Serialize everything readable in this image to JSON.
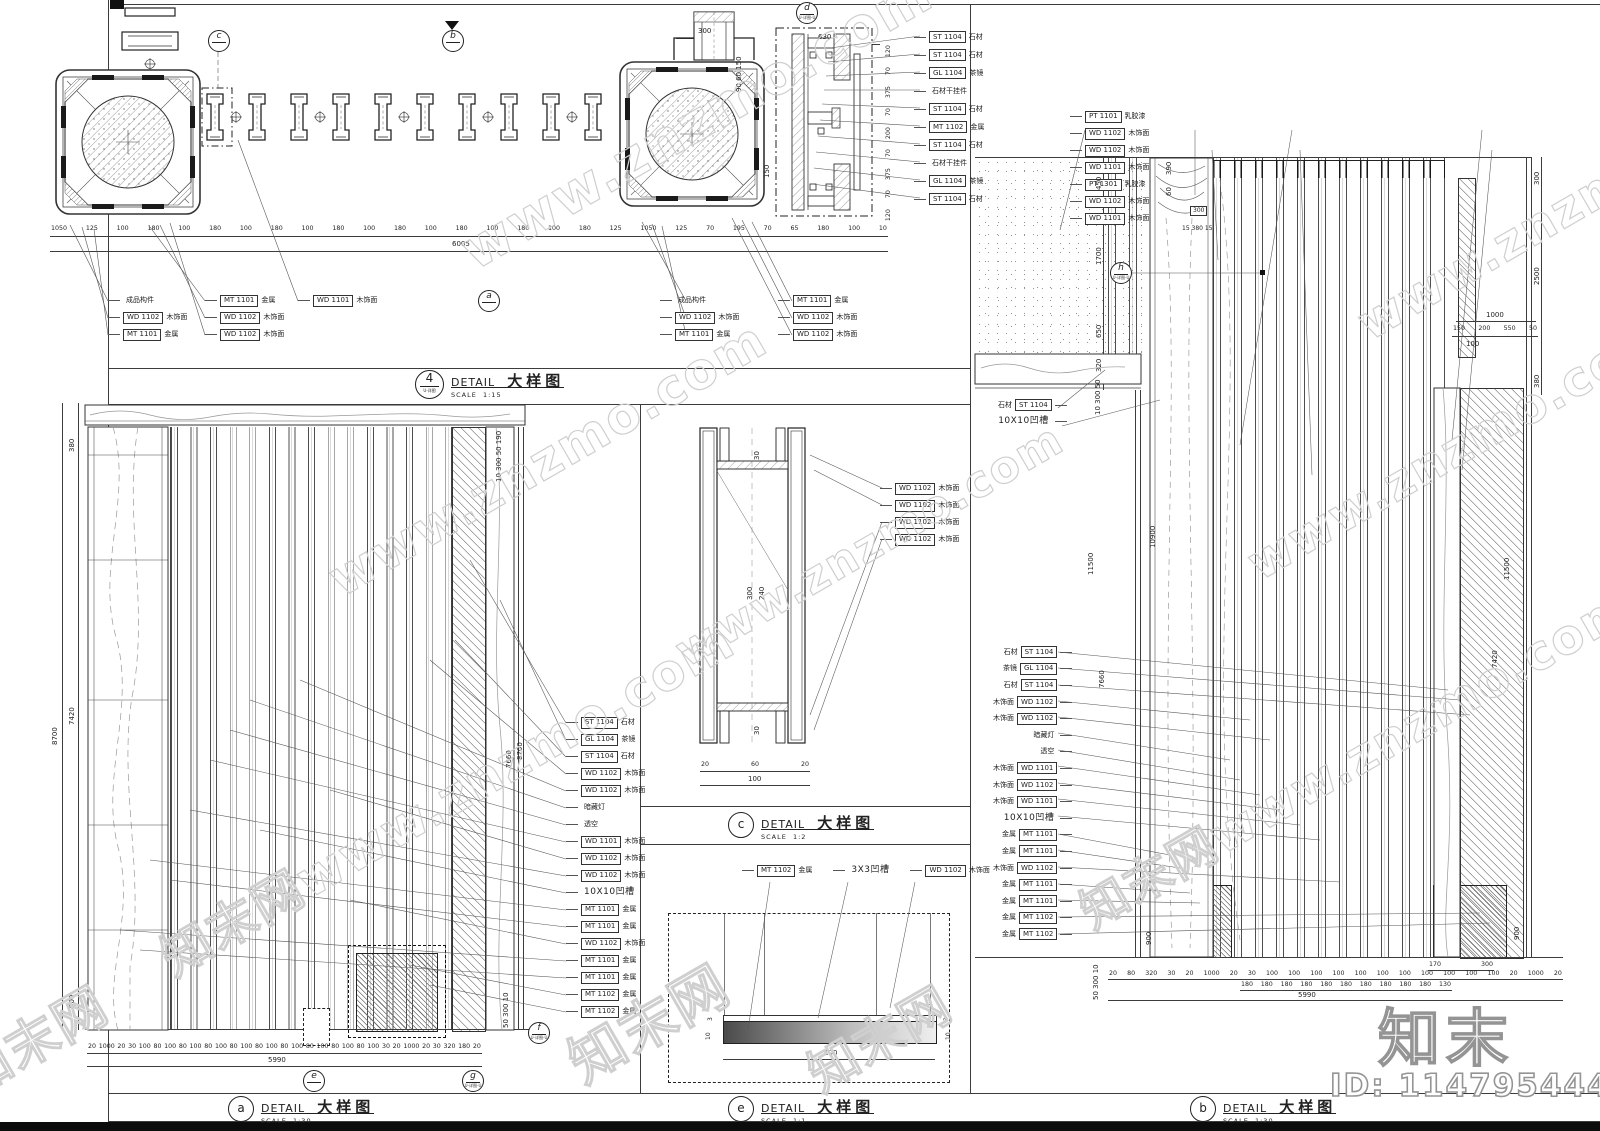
{
  "watermark": {
    "site": "www.znzmo.com",
    "brand": "知末",
    "brand_site": "知末网www.znzmo.com",
    "brand_cn": "知末网",
    "id_text": "ID: 1147954446"
  },
  "common": {
    "detail": "DETAIL",
    "detail_cn": "大样图",
    "scale": "SCALE"
  },
  "d4": {
    "num": "4",
    "circle_sub": "U-详图",
    "scale_val": "1:15",
    "dims_row": [
      "1050",
      "125",
      "100",
      "180",
      "100",
      "180",
      "100",
      "180",
      "100",
      "180",
      "100",
      "180",
      "100",
      "180",
      "100",
      "180",
      "100",
      "180",
      "125",
      "1050",
      "125",
      "70",
      "195",
      "70",
      "65",
      "180",
      "100",
      "10"
    ],
    "total": "6005",
    "cap_dim": "300",
    "cap_small": "90 60 150",
    "d_top_dim": "630",
    "d_mid_dim": "150",
    "d_right_dims": [
      "120",
      "70",
      "375",
      "70",
      "200",
      "70",
      "375",
      "70",
      "120"
    ],
    "groupA1": [
      {
        "label": "成品构件"
      },
      {
        "box": "WD 1102",
        "label": "木饰面"
      },
      {
        "box": "MT 1101",
        "label": "金属"
      }
    ],
    "groupA2": [
      {
        "box": "MT 1101",
        "label": "金属"
      },
      {
        "box": "WD 1102",
        "label": "木饰面"
      },
      {
        "box": "WD 1102",
        "label": "木饰面"
      }
    ],
    "groupA3": [
      {
        "box": "WD 1101",
        "label": "木饰面"
      }
    ],
    "groupB1": [
      {
        "label": "成品构件"
      },
      {
        "box": "WD 1102",
        "label": "木饰面"
      },
      {
        "box": "MT 1101",
        "label": "金属"
      }
    ],
    "groupB2": [
      {
        "box": "MT 1101",
        "label": "金属"
      },
      {
        "box": "WD 1102",
        "label": "木饰面"
      },
      {
        "box": "WD 1102",
        "label": "木饰面"
      }
    ],
    "d_tags": [
      {
        "box": "ST 1104",
        "label": "石材"
      },
      {
        "box": "ST 1104",
        "label": "石材"
      },
      {
        "box": "GL 1104",
        "label": "茶镜"
      },
      {
        "label": "石材干挂件"
      },
      {
        "box": "ST 1104",
        "label": "石材"
      },
      {
        "box": "MT 1102",
        "label": "金属"
      },
      {
        "box": "ST 1104",
        "label": "石材"
      },
      {
        "label": "石材干挂件"
      },
      {
        "box": "GL 1104",
        "label": "茶镜"
      },
      {
        "box": "ST 1104",
        "label": "石材"
      }
    ],
    "marker_c": "c",
    "marker_b": "b",
    "marker_d": "d",
    "marker_a": "a",
    "marker_sub": "U-详图-U"
  },
  "da": {
    "letter": "a",
    "scale_val": "1:30",
    "left_outer": "8700",
    "dim_380": "380",
    "dim_7420": "7420",
    "dim_900": "900",
    "right_rot1": "7660",
    "right_rot2": "8700",
    "top_right_rot": "10 300 50 190",
    "bot_rot": "50 300 10",
    "tags": [
      {
        "box": "ST 1104",
        "label": "石材"
      },
      {
        "box": "GL 1104",
        "label": "茶镜"
      },
      {
        "box": "ST 1104",
        "label": "石材"
      },
      {
        "box": "WD 1102",
        "label": "木饰面"
      },
      {
        "box": "WD 1102",
        "label": "木饰面"
      },
      {
        "label": "暗藏灯"
      },
      {
        "label": "透空"
      },
      {
        "box": "WD 1101",
        "label": "木饰面"
      },
      {
        "box": "WD 1102",
        "label": "木饰面"
      },
      {
        "box": "WD 1102",
        "label": "木饰面"
      },
      {
        "label": "10X10凹槽",
        "big": true
      },
      {
        "box": "MT 1101",
        "label": "金属"
      },
      {
        "box": "MT 1101",
        "label": "金属"
      },
      {
        "box": "WD 1102",
        "label": "木饰面"
      },
      {
        "box": "MT 1101",
        "label": "金属"
      },
      {
        "box": "MT 1101",
        "label": "金属"
      },
      {
        "box": "MT 1102",
        "label": "金属"
      },
      {
        "box": "MT 1102",
        "label": "金属"
      }
    ],
    "dims_row": [
      "20",
      "1000",
      "20",
      "30",
      "100",
      "80",
      "100",
      "80",
      "100",
      "80",
      "100",
      "80",
      "100",
      "80",
      "100",
      "80",
      "100",
      "80",
      "100",
      "80",
      "100",
      "80",
      "100",
      "30",
      "20",
      "1000",
      "20",
      "30",
      "320",
      "180",
      "20"
    ],
    "total": "5990",
    "marker_e": "e",
    "marker_g": "g",
    "marker_f": "f",
    "marker_sub": "U-详图-U"
  },
  "dc": {
    "letter": "c",
    "scale_val": "1:2",
    "dim_top": "30",
    "dim_mid1": "300",
    "dim_mid2": "240",
    "dim_bot": "30",
    "dims_row": [
      "20",
      "60",
      "20"
    ],
    "total": "100",
    "tags": [
      {
        "box": "WD 1102",
        "label": "木饰面"
      },
      {
        "box": "WD 1102",
        "label": "木饰面"
      },
      {
        "box": "WD 1102",
        "label": "木饰面"
      },
      {
        "box": "WD 1102",
        "label": "木饰面"
      }
    ]
  },
  "de": {
    "letter": "e",
    "scale_val": "1:1",
    "tags": [
      {
        "box": "MT 1102",
        "label": "金属"
      },
      {
        "label": "3X3凹槽",
        "big": true
      },
      {
        "box": "WD 1102",
        "label": "木饰面"
      }
    ],
    "dim_3a": "3",
    "dim_3b": "3",
    "dim_10a": "10",
    "dim_3c": "3",
    "dim_10b": "10",
    "total": "100"
  },
  "db": {
    "letter": "b",
    "scale_val": "1:30",
    "top_tags": [
      {
        "box": "PT 1101",
        "label": "乳胶漆"
      },
      {
        "box": "WD 1102",
        "label": "木饰面"
      },
      {
        "box": "WD 1102",
        "label": "木饰面"
      },
      {
        "box": "WD 1101",
        "label": "木饰面"
      },
      {
        "box": "PT 1301",
        "label": "乳胶漆"
      },
      {
        "box": "WD 1102",
        "label": "木饰面"
      },
      {
        "box": "WD 1101",
        "label": "木饰面"
      }
    ],
    "upper_tags": [
      {
        "label": "石材",
        "box": "ST 1104"
      },
      {
        "label": "10X10凹槽",
        "big": true
      }
    ],
    "tags": [
      {
        "label": "石材",
        "box": "ST 1104"
      },
      {
        "label": "茶镜",
        "box": "GL 1104"
      },
      {
        "label": "石材",
        "box": "ST 1104"
      },
      {
        "label": "木饰面",
        "box": "WD 1102"
      },
      {
        "label": "木饰面",
        "box": "WD 1102"
      },
      {
        "label": "暗藏灯"
      },
      {
        "label": "透空"
      },
      {
        "label": "木饰面",
        "box": "WD 1101"
      },
      {
        "label": "木饰面",
        "box": "WD 1102"
      },
      {
        "label": "木饰面",
        "box": "WD 1101"
      },
      {
        "label": "10X10凹槽",
        "big": true
      },
      {
        "label": "金属",
        "box": "MT 1101"
      },
      {
        "label": "金属",
        "box": "MT 1101"
      },
      {
        "label": "木饰面",
        "box": "WD 1102"
      },
      {
        "label": "金属",
        "box": "MT 1101"
      },
      {
        "label": "金属",
        "box": "MT 1101"
      },
      {
        "label": "金属",
        "box": "MT 1102"
      },
      {
        "label": "金属",
        "box": "MT 1102"
      }
    ],
    "chain_450": "450",
    "chain_1700": "1700",
    "chain_650": "650",
    "chain_320": "320",
    "rot_390": "390",
    "rot_60": "60",
    "wood_dim1": "300",
    "wood_dim2": "15 380 15",
    "mid_rot1": "10 300 50",
    "mid_rot2": "11500",
    "mid_rot3": "10900",
    "mid_rot4": "7660",
    "r_300": "300",
    "r_2500": "2500",
    "r_380": "380",
    "r_11500": "11500",
    "r_7420": "7420",
    "r1000": "1000",
    "rrow": [
      "150",
      "200",
      "550",
      "50"
    ],
    "r100": "100",
    "bot_rot": "50 300 10",
    "rot900l": "900",
    "rot900r": "900",
    "dims_row1": [
      "20",
      "80",
      "320",
      "30",
      "20",
      "1000",
      "20",
      "30",
      "100",
      "100",
      "100",
      "100",
      "100",
      "100",
      "100",
      "100",
      "100",
      "100",
      "100",
      "20",
      "1000",
      "20"
    ],
    "dims_row2": [
      "180",
      "180",
      "180",
      "180",
      "180",
      "180",
      "180",
      "180",
      "180",
      "180",
      "130"
    ],
    "sub_dims": [
      "170",
      "300"
    ],
    "total": "5990",
    "marker_h": "h",
    "marker_sub": "U-详图-U"
  }
}
